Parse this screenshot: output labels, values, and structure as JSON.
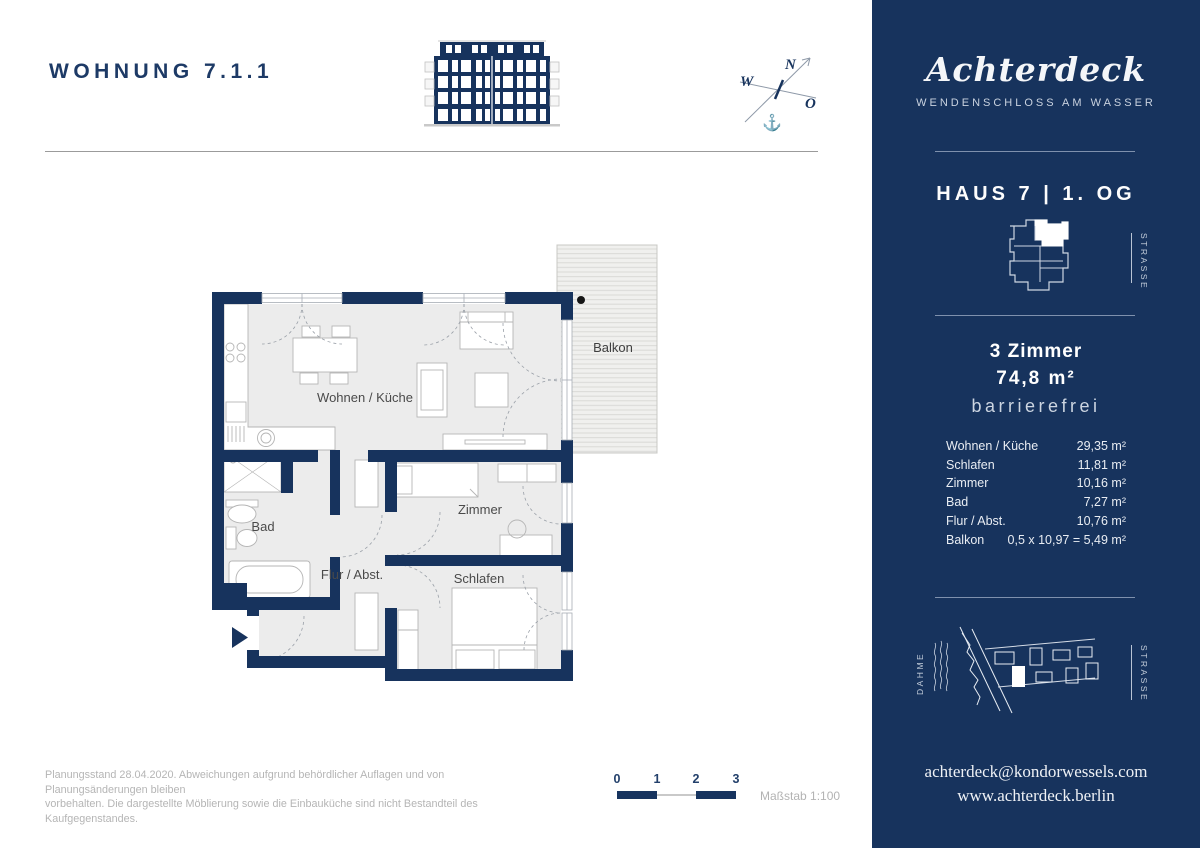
{
  "header": {
    "title": "WOHNUNG 7.1.1"
  },
  "compass": {
    "n": "N",
    "w": "W",
    "o": "O",
    "anchor_icon": "anchor"
  },
  "floorplan": {
    "rooms": {
      "living": "Wohnen / Küche",
      "bath": "Bad",
      "hall": "Flur / Abst.",
      "room": "Zimmer",
      "sleep": "Schlafen",
      "balcony": "Balkon"
    }
  },
  "sidebar": {
    "logo": "Achterdeck",
    "tagline": "WENDENSCHLOSS AM WASSER",
    "unit_title": "HAUS 7 | 1. OG",
    "locator_street": "STRASSE",
    "summary": {
      "rooms": "3 Zimmer",
      "area": "74,8 m²",
      "feature": "barrierefrei"
    },
    "areas": [
      {
        "label": "Wohnen / Küche",
        "value": "29,35 m²"
      },
      {
        "label": "Schlafen",
        "value": "11,81 m²"
      },
      {
        "label": "Zimmer",
        "value": "10,16 m²"
      },
      {
        "label": "Bad",
        "value": "7,27 m²"
      },
      {
        "label": "Flur / Abst.",
        "value": "10,76 m²"
      },
      {
        "label": "Balkon",
        "value": "0,5 x 10,97 = 5,49 m²"
      }
    ],
    "siteplan": {
      "river": "DAHME",
      "street": "STRASSE"
    },
    "contact": {
      "email": "achterdeck@kondorwessels.com",
      "website": "www.achterdeck.berlin"
    }
  },
  "footer": {
    "disclaimer_line1": "Planungsstand 28.04.2020. Abweichungen aufgrund behördlicher Auflagen und von Planungsänderungen bleiben",
    "disclaimer_line2": "vorbehalten. Die dargestellte Möblierung sowie die Einbauküche sind nicht Bestandteil des Kaufgegenstandes.",
    "scale": {
      "ticks": [
        "0",
        "1",
        "2",
        "3"
      ],
      "label": "Maßstab 1:100"
    }
  },
  "colors": {
    "navy": "#17335d",
    "room_fill": "#ececec",
    "balcony_fill": "#f0f0ee",
    "furniture_line": "#b5b5b5",
    "muted_text": "#b5b5b5"
  }
}
